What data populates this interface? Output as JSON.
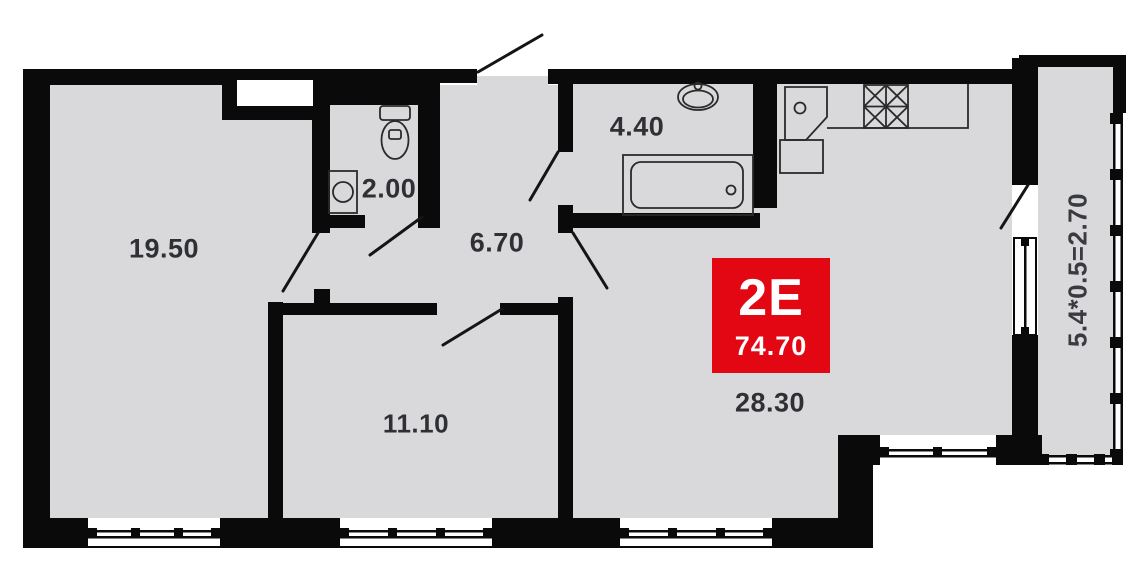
{
  "badge": {
    "type": "2E",
    "total_area": "74.70"
  },
  "rooms": [
    {
      "name": "room-19-50",
      "area": "19.50"
    },
    {
      "name": "wc-2-00",
      "area": "2.00"
    },
    {
      "name": "hall-6-70",
      "area": "6.70"
    },
    {
      "name": "bathroom-4-40",
      "area": "4.40"
    },
    {
      "name": "room-11-10",
      "area": "11.10"
    },
    {
      "name": "kitchen-living-28-30",
      "area": "28.30"
    }
  ],
  "balcony": {
    "formula": "5.4*0.5=2.70"
  },
  "colors": {
    "wall": "#0a0a0a",
    "floor": "#d9d9dc",
    "label": "#2f3034",
    "badge_red": "#e30613",
    "badge_text": "#ffffff",
    "fixture_outline": "#2a2a2a"
  }
}
